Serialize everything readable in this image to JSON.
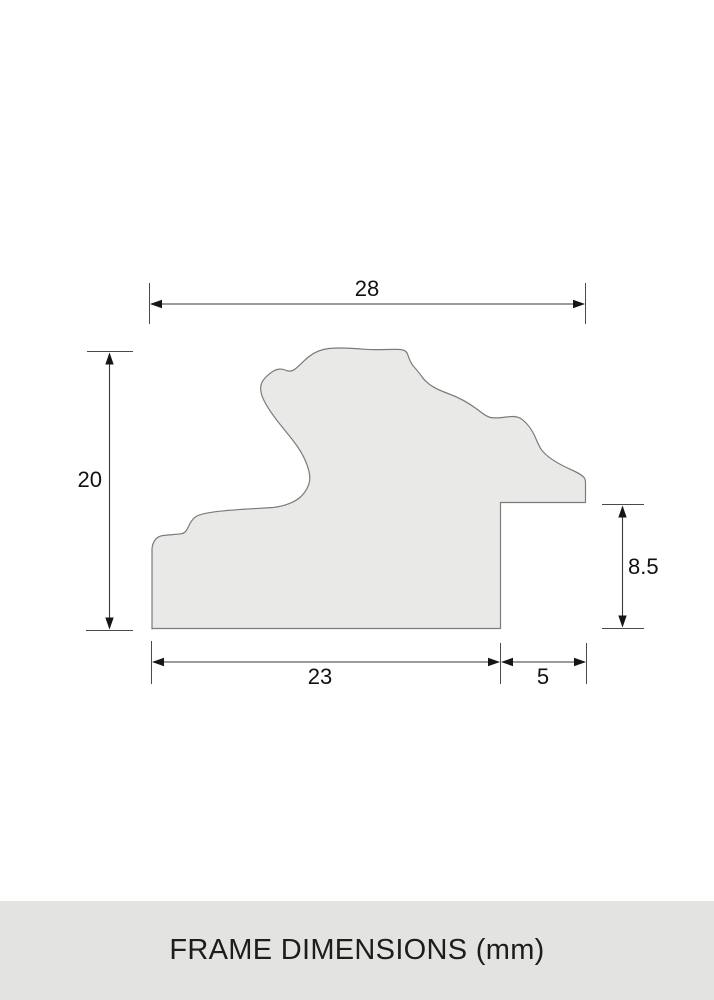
{
  "diagram": {
    "labels": {
      "top_width": "28",
      "left_height": "20",
      "rabbet_height": "8.5",
      "bottom_width": "23",
      "rabbet_width": "5"
    },
    "colors": {
      "shape_fill": "#e9e9e7",
      "shape_stroke": "#7b7b79",
      "dimension_line": "#3a3a3a",
      "tick": "#4a4a4a",
      "label_text": "#111111"
    }
  },
  "footer": {
    "label": "FRAME DIMENSIONS (mm)",
    "background": "#e3e3e1",
    "text_color": "#1d1d1b"
  }
}
